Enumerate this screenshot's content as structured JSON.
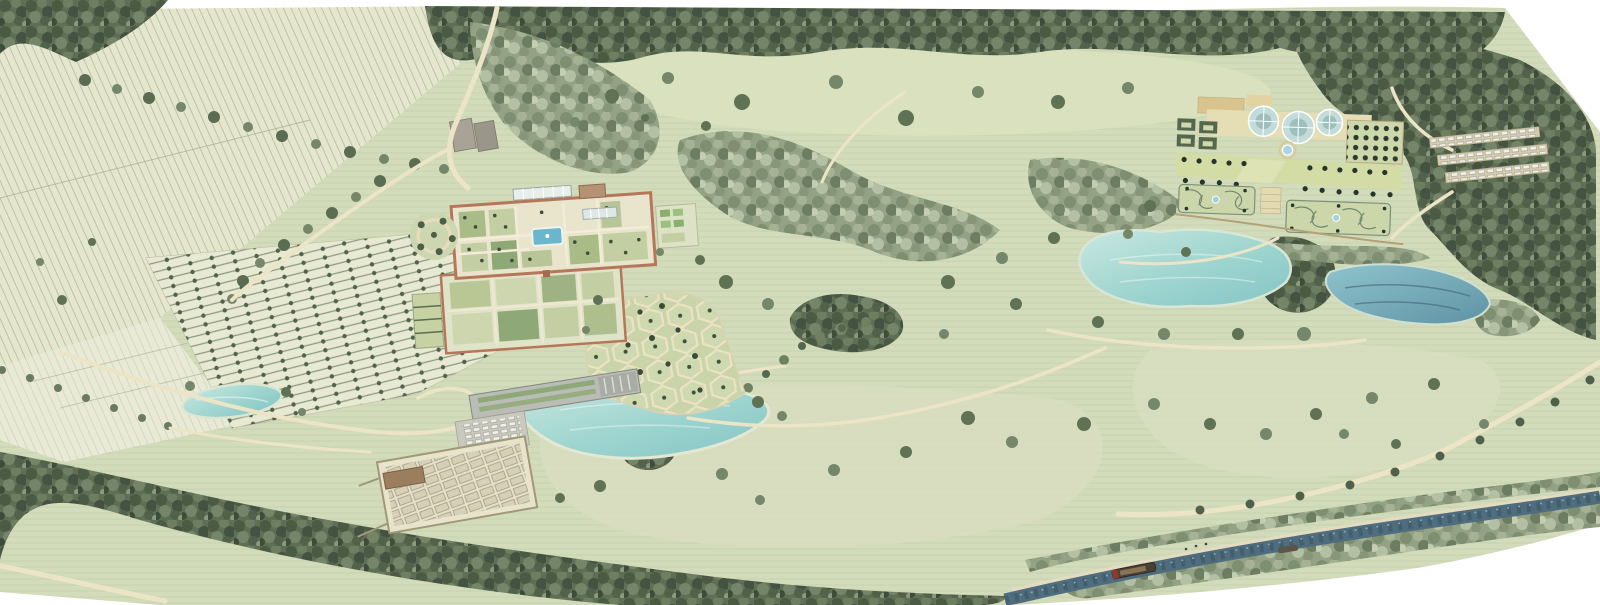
{
  "meta": {
    "title": "Illustrated estate masterplan — aerial watercolour view",
    "description": "Hand-drawn watercolour aerial masterplan of a large garden estate: ploughed fields and an orchard car park to the west, a brick walled garden with central pool, a cellular wellbeing garden, a long visitor centre with car park and allotments beside a lake, open parkland with scattered trees, a formal terrace garden with three glass domes and scroll parterres above two lakes to the east, woodland belts all around, and a canal with a barge running along the south-east edge."
  },
  "palette": {
    "page_white": "#ffffff",
    "parkland_green": "#d3dcba",
    "glade_green": "#d9e1bf",
    "field_pale": "#e4e7cd",
    "woodland_dark": "#5f6f55",
    "woodland_light": "#93a284",
    "lake_turquoise": "#8ecdc9",
    "lake_deep": "#5f93a4",
    "canal_blue": "#4f6d7e",
    "path_tan": "#ece4c6",
    "brick_wall": "#b5765a",
    "glasshouse_glass": "#c3dbd9",
    "terrace_tan": "#e5deb4",
    "parterre_hedge": "#75876e",
    "roof_grey": "#b9bdb5"
  },
  "features": [
    {
      "id": "upper-fields",
      "label": "Ploughed fields"
    },
    {
      "id": "orchard-car-park",
      "label": "Hedged orchard rows"
    },
    {
      "id": "small-pond",
      "label": "Small pond"
    },
    {
      "id": "walled-garden",
      "label": "Walled garden with pool and glasshouses"
    },
    {
      "id": "garden-mount",
      "label": "Tree mount"
    },
    {
      "id": "cellular-garden",
      "label": "Cellular wellbeing garden"
    },
    {
      "id": "visitor-centre",
      "label": "Visitor centre and car park"
    },
    {
      "id": "allotments",
      "label": "Walled allotment garden"
    },
    {
      "id": "middle-lake",
      "label": "Visitor centre lake"
    },
    {
      "id": "great-meadow",
      "label": "Open parkland meadow"
    },
    {
      "id": "formal-garden",
      "label": "Formal terrace garden with glass domes"
    },
    {
      "id": "parterres",
      "label": "Scroll parterres with fountains"
    },
    {
      "id": "west-lake",
      "label": "Western garden lake"
    },
    {
      "id": "east-lake",
      "label": "Eastern garden lake"
    },
    {
      "id": "woodland-car-park",
      "label": "Car park in woodland"
    },
    {
      "id": "entrance-drive",
      "label": "Tree-lined entrance drive"
    },
    {
      "id": "canal",
      "label": "Canal with barge and towpath"
    },
    {
      "id": "woodland-belts",
      "label": "Woodland belts"
    }
  ]
}
